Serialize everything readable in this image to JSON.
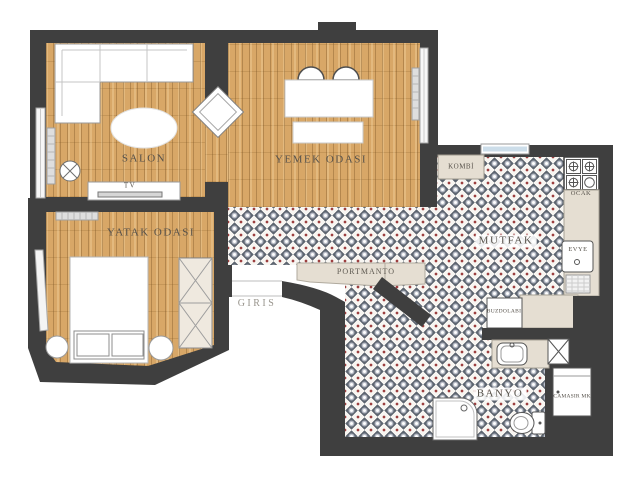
{
  "labels": {
    "salon": "SALON",
    "dining": "YEMEK ODASI",
    "bedroom": "YATAK ODASI",
    "kitchen": "MUTFAK",
    "bathroom": "BANYO",
    "entry": "GIRIS",
    "coatrack": "PORTMANTO",
    "boiler": "KOMBİ",
    "stove": "OCAK",
    "sink": "EVYE",
    "fridge": "BUZDOLABI",
    "washer": "CAMASIR MK",
    "tv": "TV"
  },
  "colors": {
    "wall": "#3f3f3f",
    "wood_floor": "#d8a767",
    "tile_red": "#9c3f3f",
    "tile_slate": "#5d6570",
    "counter_beige": "#e5ded2",
    "window_glass": "#ccdde9"
  }
}
